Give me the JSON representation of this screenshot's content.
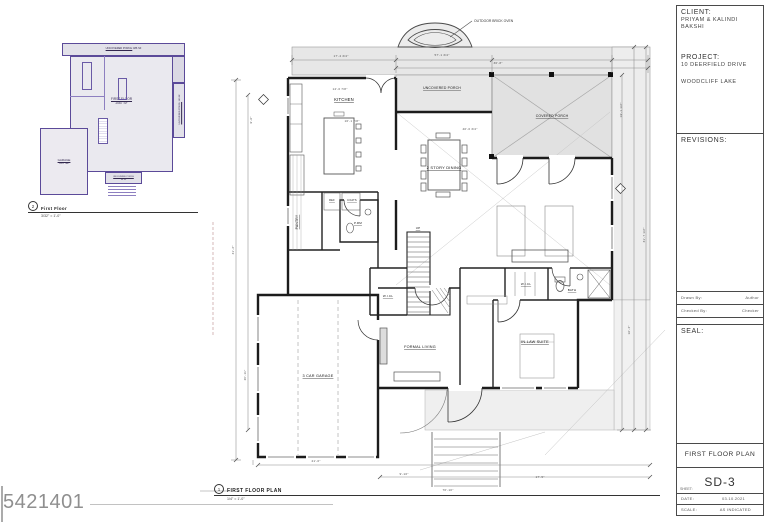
{
  "watermark": {
    "id": "5421401"
  },
  "titleblock": {
    "client_label": "CLIENT:",
    "client_line1": "PRIYAM & KALINDI",
    "client_line2": "BAKSHI",
    "project_label": "PROJECT:",
    "project_line1": "10 DEERFIELD DRIVE",
    "project_line2": "WOODCLIFF LAKE",
    "revisions_label": "REVISIONS:",
    "drawn_by_label": "Drawn By:",
    "drawn_by_value": "Author",
    "checked_by_label": "Checked By:",
    "checked_by_value": "Checker",
    "seal_label": "SEAL:",
    "architect_lines": [
      "GREGORY RALPH",
      "ARCHITECT",
      "LICENSE: 18893",
      "1234 RT 23 S",
      "BOUND BROOK, NJ 08805",
      "TEL: 908 731 1234",
      "GREG@GRALPHARCHITECT.COM"
    ],
    "sheet_title": "FIRST FLOOR PLAN",
    "sheet_label": "SHEET:",
    "sheet_number": "SD-3",
    "date_label": "DATE:",
    "date_value": "03.10.2021",
    "scale_label": "SCALE:",
    "scale_value": "AS INDICATED"
  },
  "inset": {
    "areas": [
      {
        "name": "UNCOVERED PORCH",
        "sf": "486 SF",
        "x": 26,
        "y": 3,
        "w": 123,
        "h": 13,
        "fill": "#e2e1e9",
        "fs": 2.6,
        "oneline": true
      },
      {
        "name": "COVERED PORCH",
        "sf": "276 SF",
        "x": 92,
        "y": 16,
        "w": 57,
        "h": 27,
        "fill": "#dbd9e4",
        "fs": 2.8
      },
      {
        "name": "FIRST FLOOR",
        "sf": "2067 SF",
        "x": 34,
        "y": 16,
        "w": 103,
        "h": 116,
        "fill": "#eae9ef",
        "fs": 3.2,
        "labeltop": 40
      },
      {
        "name": "GARAGE",
        "sf": "667 SF",
        "x": 4,
        "y": 88,
        "w": 48,
        "h": 67,
        "fill": "#eceaf0",
        "fs": 3
      },
      {
        "name": "UNCOVERED PORCH",
        "sf": "190 SF",
        "x": 137,
        "y": 43,
        "w": 12,
        "h": 55,
        "fill": "#e2e1e9",
        "fs": 2.2,
        "vertical": true
      },
      {
        "name": "UNCOVERED PORCH",
        "sf": "66 SF",
        "x": 69,
        "y": 132,
        "w": 37,
        "h": 12,
        "fill": "#e2e1e9",
        "fs": 2
      }
    ],
    "caption_number": "2",
    "caption_title": "First Floor",
    "caption_scale": "3/32\" = 1'-0\""
  },
  "mainplan": {
    "caption_number": "1",
    "caption_title": "FIRST FLOOR PLAN",
    "caption_scale": "1/4\" = 1'-0\"",
    "annotation": "OUTDOOR BRICK OVEN",
    "rooms": [
      {
        "t": "KITCHEN",
        "x": 344,
        "y": 101,
        "s": 4.2
      },
      {
        "t": "UNCOVERED PORCH",
        "x": 442,
        "y": 89,
        "s": 3.4
      },
      {
        "t": "COVERED PORCH",
        "x": 552,
        "y": 117,
        "s": 3.4
      },
      {
        "t": "2 STORY DINING",
        "x": 444,
        "y": 169,
        "s": 4
      },
      {
        "t": "PANTRY",
        "x": 298,
        "y": 222,
        "s": 3.4,
        "r": -90
      },
      {
        "t": "REF",
        "x": 332,
        "y": 201,
        "s": 2.6
      },
      {
        "t": "COATS",
        "x": 352,
        "y": 201,
        "s": 2.6
      },
      {
        "t": "P.RM",
        "x": 358,
        "y": 224,
        "s": 3
      },
      {
        "t": "UP",
        "x": 418,
        "y": 229,
        "s": 3
      },
      {
        "t": "W.I.CL",
        "x": 388,
        "y": 297,
        "s": 3
      },
      {
        "t": "FORMAL LIVING",
        "x": 420,
        "y": 348,
        "s": 3.8
      },
      {
        "t": "3 CAR GARAGE",
        "x": 318,
        "y": 377,
        "s": 3.8
      },
      {
        "t": "W.I.CL",
        "x": 526,
        "y": 285,
        "s": 3
      },
      {
        "t": "BATH",
        "x": 572,
        "y": 291,
        "s": 3
      },
      {
        "t": "IN-LAW SUITE",
        "x": 535,
        "y": 343,
        "s": 3.8
      }
    ],
    "dims": [
      {
        "t": "17'-4 3/4\"",
        "x": 341,
        "y": 57
      },
      {
        "t": "57'-1 3/4\"",
        "x": 442,
        "y": 56
      },
      {
        "t": "36'-8\"",
        "x": 498,
        "y": 64
      },
      {
        "t": "14'-0 7/8\"",
        "x": 340,
        "y": 90
      },
      {
        "t": "16'-1 7/8\"",
        "x": 352,
        "y": 122
      },
      {
        "t": "40'-0 3/4\"",
        "x": 470,
        "y": 130
      },
      {
        "t": "9'-6\"",
        "x": 252,
        "y": 120,
        "r": -90
      },
      {
        "t": "41'-2\"",
        "x": 234,
        "y": 250,
        "r": -90
      },
      {
        "t": "20'-11\"",
        "x": 246,
        "y": 375,
        "r": -90
      },
      {
        "t": "19'-1 1/2\"",
        "x": 622,
        "y": 110,
        "r": -90
      },
      {
        "t": "31'-7 1/2\"",
        "x": 645,
        "y": 235,
        "r": -90
      },
      {
        "t": "16'-4\"",
        "x": 630,
        "y": 330,
        "r": -90
      },
      {
        "t": "21'-0\"",
        "x": 316,
        "y": 462
      },
      {
        "t": "9'-10\"",
        "x": 404,
        "y": 475
      },
      {
        "t": "17'-5\"",
        "x": 540,
        "y": 478
      },
      {
        "t": "70'-10\"",
        "x": 448,
        "y": 491
      }
    ]
  }
}
